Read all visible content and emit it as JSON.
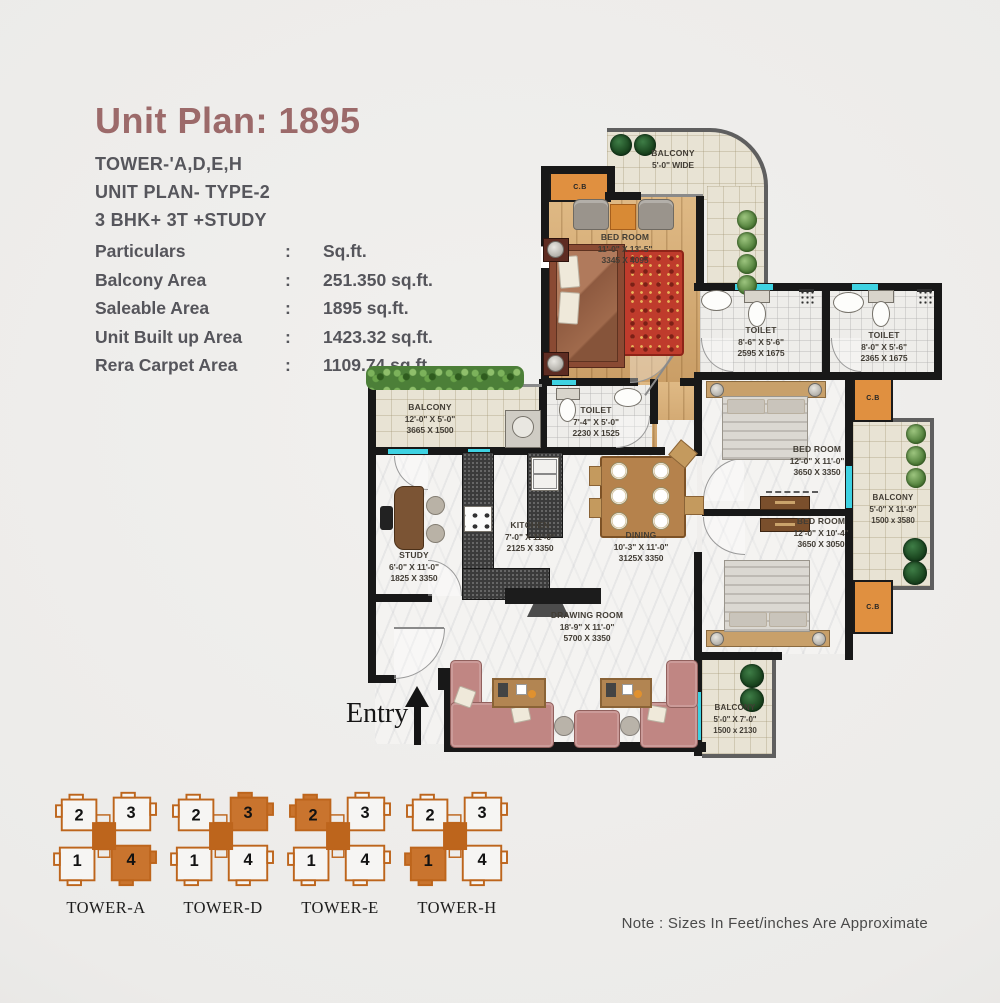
{
  "page": {
    "title": "Unit Plan: 1895",
    "note": "Note : Sizes In Feet/inches Are Approximate"
  },
  "header": {
    "tower_line": "TOWER-'A,D,E,H",
    "type_line": "UNIT PLAN- TYPE-2",
    "config_line": "3 BHK+ 3T +STUDY",
    "particulars": {
      "colon": ":",
      "header": {
        "label": "Particulars",
        "value": "Sq.ft."
      },
      "rows": [
        {
          "label": "Balcony Area",
          "value": "251.350 sq.ft."
        },
        {
          "label": "Saleable Area",
          "value": "1895 sq.ft."
        },
        {
          "label": "Unit Built up Area",
          "value": "1423.32 sq.ft."
        },
        {
          "label": "Rera Carpet  Area",
          "value": "1109.74 sq.ft."
        }
      ]
    }
  },
  "plan": {
    "entry_label": "Entry",
    "cb_label": "C.B",
    "rooms": {
      "balcony_top": {
        "name": "BALCONY",
        "dim_ft": "5'-0\" WIDE",
        "dim_mm": ""
      },
      "master_bedroom": {
        "name": "BED ROOM",
        "dim_ft": "11'-0\" X 13'-5\"",
        "dim_mm": "3345 X 4095"
      },
      "toilet_1": {
        "name": "TOILET",
        "dim_ft": "8'-6\" X 5'-6\"",
        "dim_mm": "2595 X 1675"
      },
      "toilet_2": {
        "name": "TOILET",
        "dim_ft": "8'-0\" X 5'-6\"",
        "dim_mm": "2365 X 1675"
      },
      "toilet_3": {
        "name": "TOILET",
        "dim_ft": "7'-4\" X 5'-0\"",
        "dim_mm": "2230 X 1525"
      },
      "balcony_left": {
        "name": "BALCONY",
        "dim_ft": "12'-0\" X 5'-0\"",
        "dim_mm": "3665 X 1500"
      },
      "study": {
        "name": "STUDY",
        "dim_ft": "6'-0\" X 11'-0\"",
        "dim_mm": "1825 X 3350"
      },
      "kitchen": {
        "name": "KITCHEN",
        "dim_ft": "7'-0\" X 11'-0\"",
        "dim_mm": "2125 X 3350"
      },
      "dining": {
        "name": "DINING",
        "dim_ft": "10'-3\" X 11'-0\"",
        "dim_mm": "3125X 3350"
      },
      "drawing_room": {
        "name": "DRAWING ROOM",
        "dim_ft": "18'-9\" X 11'-0\"",
        "dim_mm": "5700 X 3350"
      },
      "bedroom_2": {
        "name": "BED ROOM",
        "dim_ft": "12'-0\" X 11'-0\"",
        "dim_mm": "3650 X 3350"
      },
      "bedroom_3": {
        "name": "BED ROOM",
        "dim_ft": "12'-0\" X 10'-4\"",
        "dim_mm": "3650 X 3050"
      },
      "balcony_right": {
        "name": "BALCONY",
        "dim_ft": "5'-0\" X 11'-9\"",
        "dim_mm": "1500 x 3580"
      },
      "balcony_bottom": {
        "name": "BALCONY",
        "dim_ft": "5'-0\" X 7'-0\"",
        "dim_mm": "1500 x 2130"
      }
    }
  },
  "towers": [
    {
      "name": "TOWER-A",
      "highlighted": 4,
      "units": [
        "1",
        "2",
        "3",
        "4"
      ]
    },
    {
      "name": "TOWER-D",
      "highlighted": 3,
      "units": [
        "1",
        "2",
        "3",
        "4"
      ]
    },
    {
      "name": "TOWER-E",
      "highlighted": 2,
      "units": [
        "1",
        "2",
        "3",
        "4"
      ]
    },
    {
      "name": "TOWER-H",
      "highlighted": 1,
      "units": [
        "1",
        "2",
        "3",
        "4"
      ]
    }
  ],
  "colors": {
    "title_accent": "#9c6a6a",
    "tower_outline": "#bd651c",
    "tower_highlight": "#c9742e",
    "window_teal": "#3ed2e2",
    "cupboard_orange": "#e09040"
  }
}
